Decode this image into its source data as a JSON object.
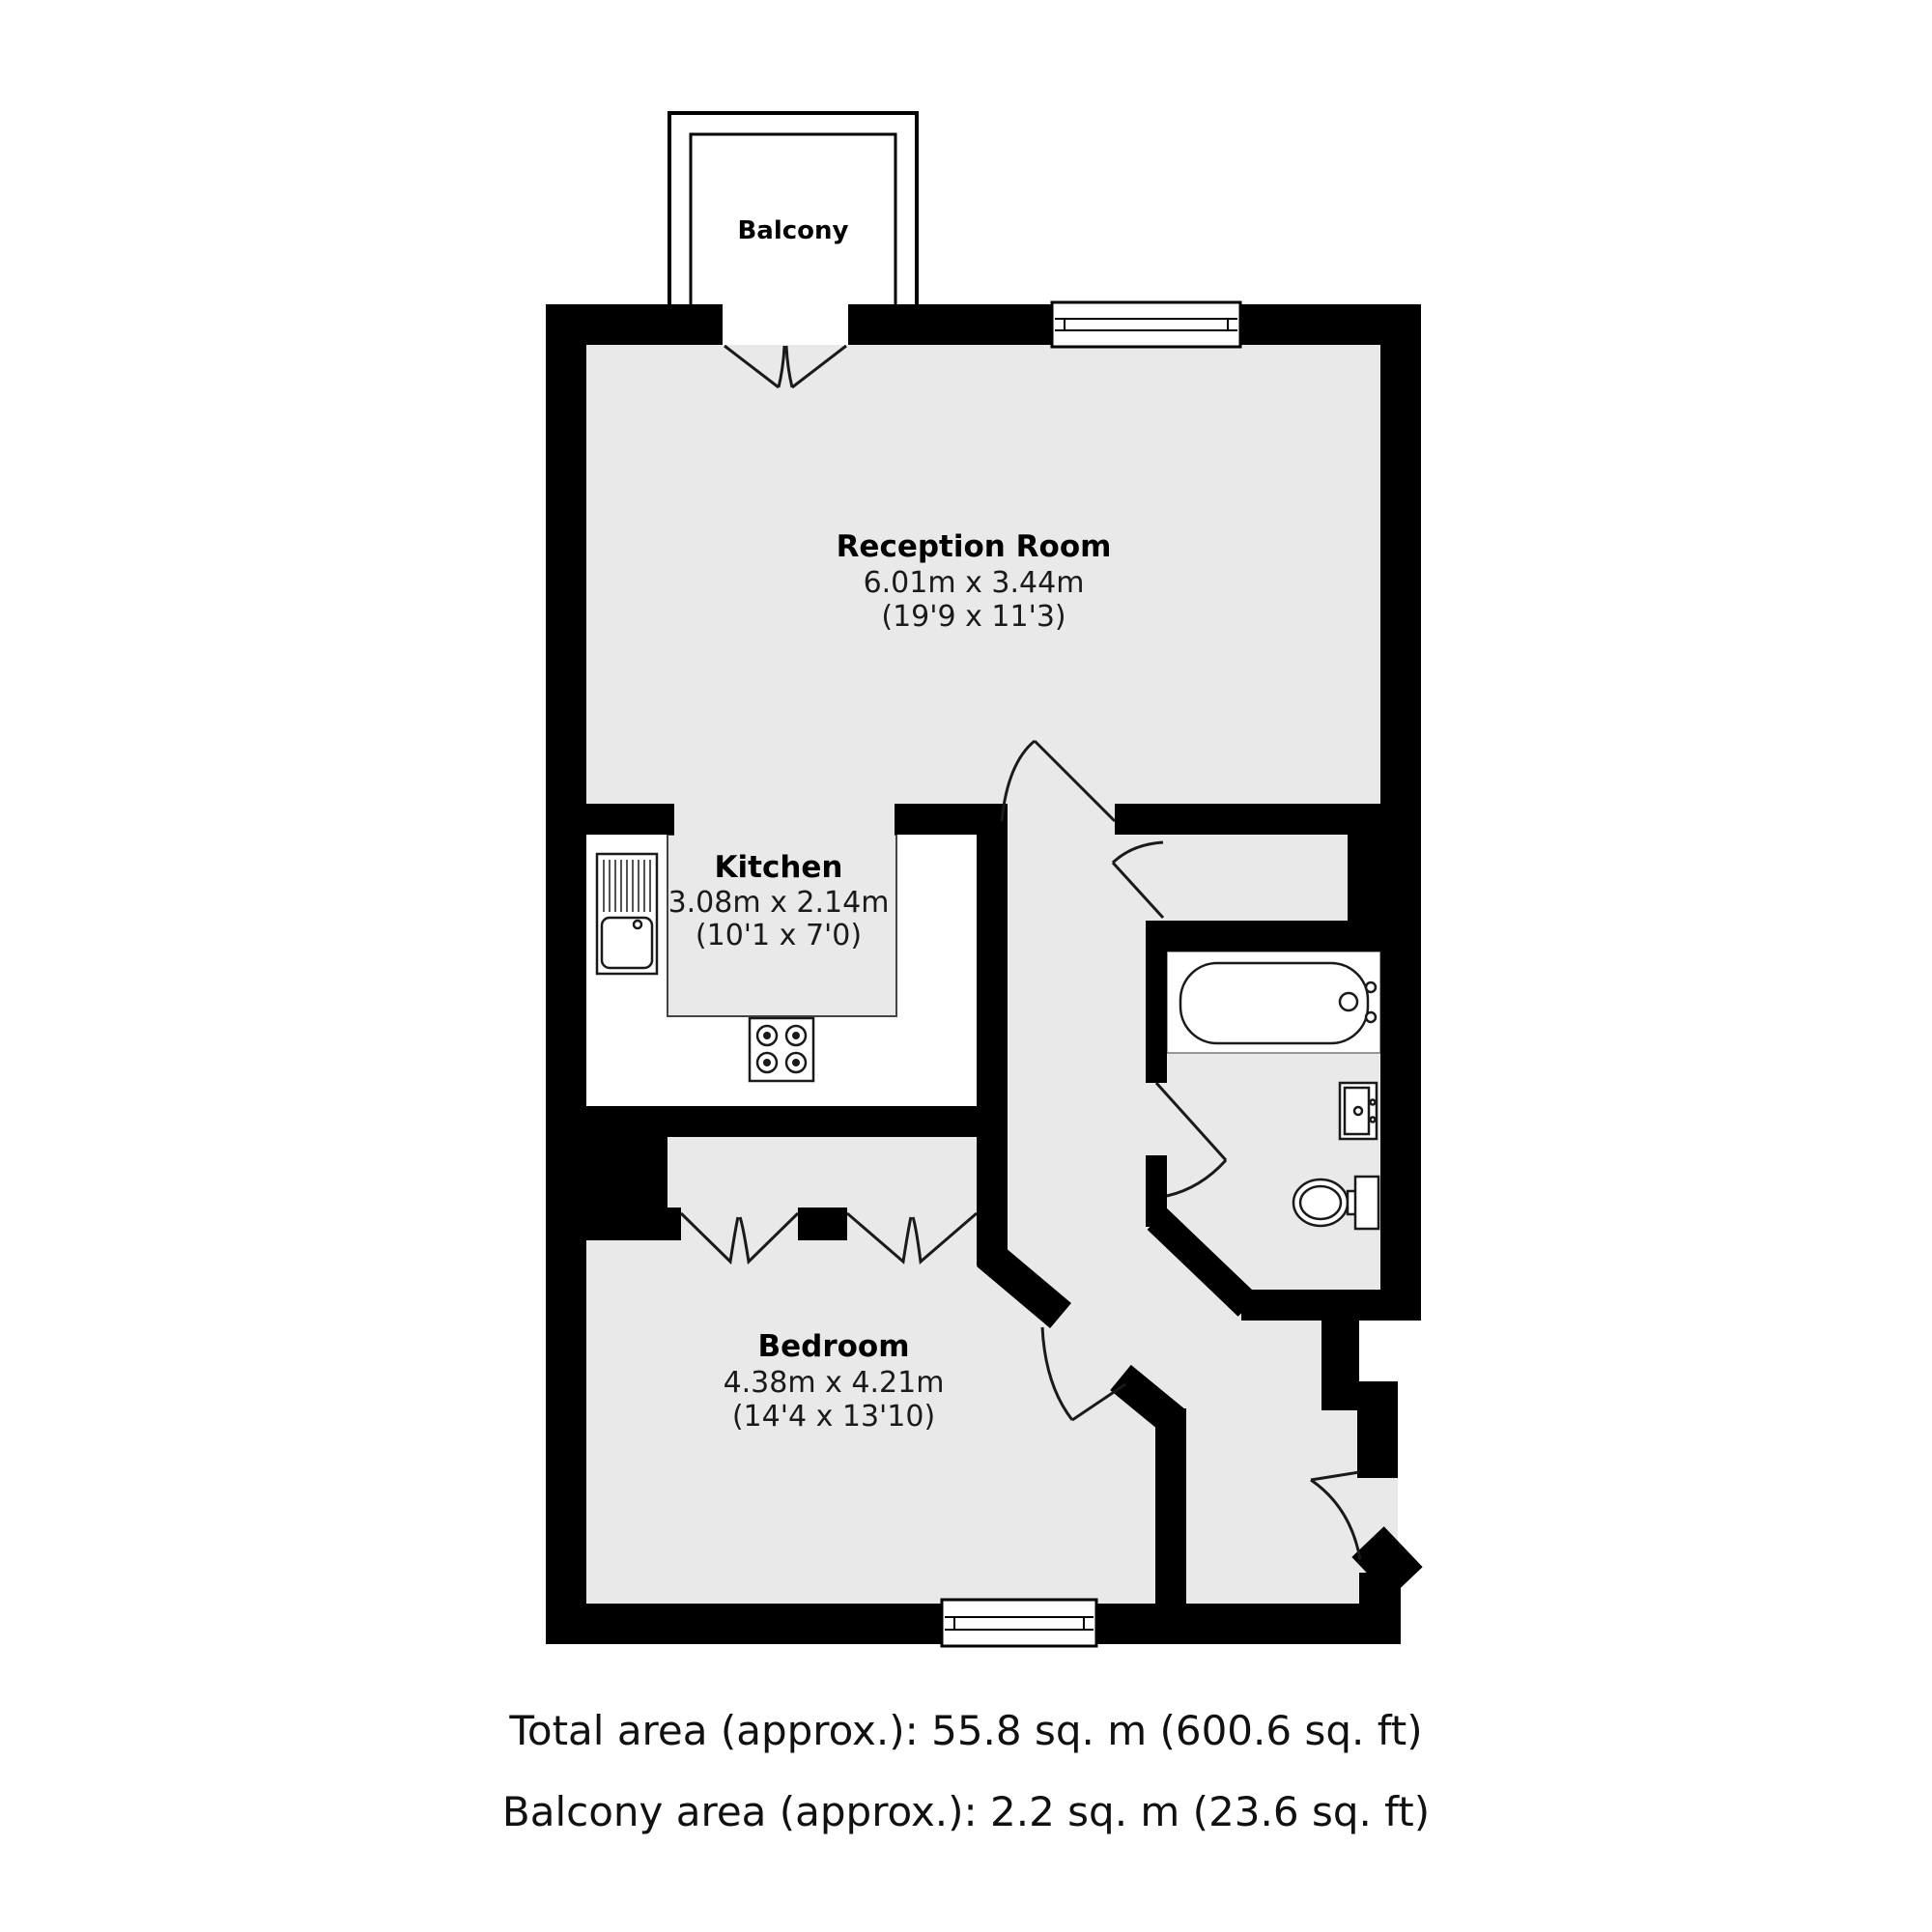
{
  "title": "Floor plan",
  "palette": {
    "background": "#ffffff",
    "wall_color": "#000000",
    "floor_color": "#e9e9e9",
    "line_color": "#1a1a1a",
    "text_color": "#111111"
  },
  "rooms": [
    {
      "id": "balcony",
      "label": "Balcony"
    },
    {
      "id": "reception",
      "label": "Reception Room",
      "size_metric": "6.01m x 3.44m",
      "size_imperial": "(19'9 x 11'3)"
    },
    {
      "id": "kitchen",
      "label": "Kitchen",
      "size_metric": "3.08m x 2.14m",
      "size_imperial": "(10'1 x 7'0)"
    },
    {
      "id": "bedroom",
      "label": "Bedroom",
      "size_metric": "4.38m x 4.21m",
      "size_imperial": "(14'4 x 13'10)"
    }
  ],
  "fixtures": [
    "kitchen-sink",
    "hob",
    "bath",
    "wash-basin",
    "toilet",
    "balcony-double-door",
    "reception-hall-door",
    "hall-cupboard-door",
    "bathroom-door",
    "bedroom-door",
    "entrance-door",
    "wardrobe-bifold-doors",
    "reception-window",
    "bedroom-window"
  ],
  "footer": {
    "total_area": "Total area (approx.): 55.8 sq. m (600.6 sq. ft)",
    "balcony_area": "Balcony area (approx.): 2.2 sq. m (23.6 sq. ft)"
  }
}
